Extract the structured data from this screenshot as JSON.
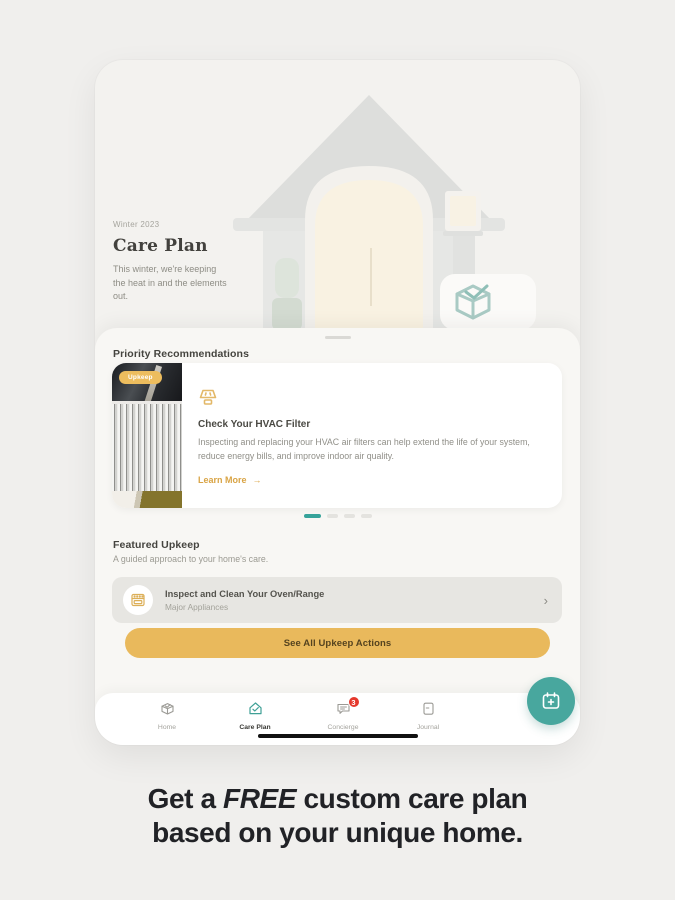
{
  "app": {
    "hero": {
      "season_label": "Winter 2023",
      "title": "Care Plan",
      "description": "This winter, we're keeping the heat in and the elements out."
    },
    "priority": {
      "heading": "Priority Recommendations",
      "card": {
        "badge": "Upkeep",
        "title": "Check Your HVAC Filter",
        "description": "Inspecting and replacing your HVAC air filters can help extend the life of your system, reduce energy bills, and improve indoor air quality.",
        "link_label": "Learn More"
      },
      "carousel": {
        "total": 4,
        "active_index": 0
      }
    },
    "featured": {
      "heading": "Featured Upkeep",
      "subheading": "A guided approach to your home's care.",
      "item": {
        "title": "Inspect and Clean Your Oven/Range",
        "subtitle": "Major Appliances"
      },
      "cta_label": "See All Upkeep Actions"
    },
    "tabbar": {
      "items": [
        {
          "label": "Home"
        },
        {
          "label": "Care Plan"
        },
        {
          "label": "Concierge",
          "badge": "3"
        },
        {
          "label": "Journal"
        }
      ]
    }
  },
  "caption": {
    "prefix": "Get a ",
    "emphasis": "FREE",
    "suffix": " custom care plan",
    "line2": "based on your unique home."
  },
  "icons": {
    "chevron_right": "›",
    "arrow_right": "→"
  },
  "colors": {
    "accent_gold": "#e9b95c",
    "teal": "#48a79e",
    "badge_red": "#e5382c",
    "page_background": "#f0efed"
  }
}
